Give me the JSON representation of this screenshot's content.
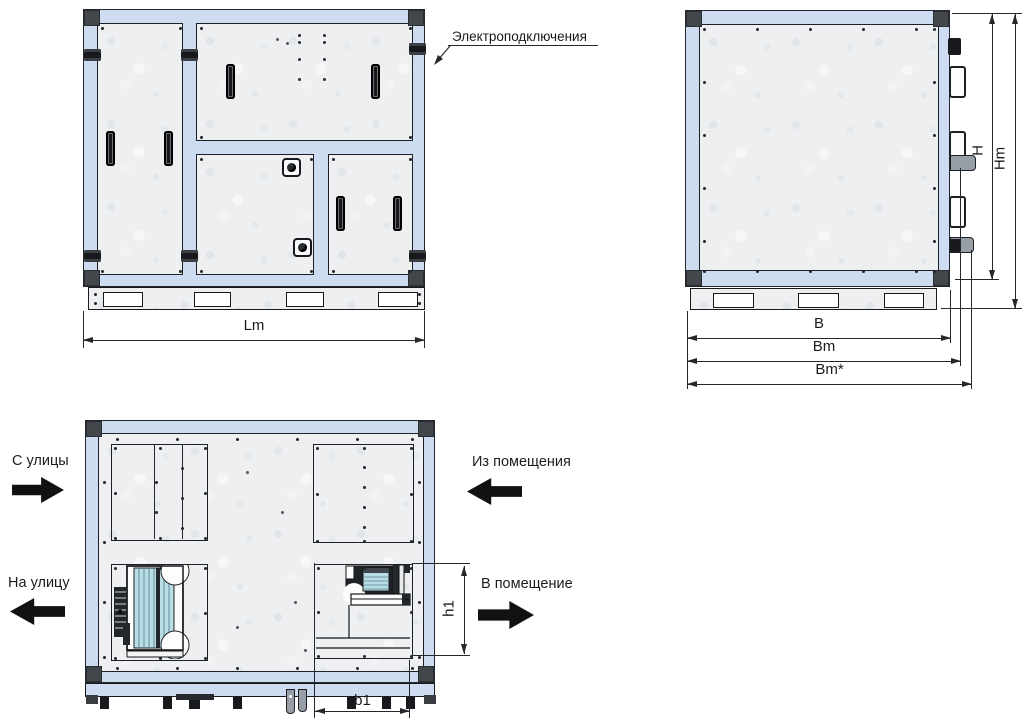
{
  "annotation": {
    "electrical": "Электроподключения"
  },
  "airflow": {
    "from_street": "С улицы",
    "to_street": "На улицу",
    "from_room": "Из помещения",
    "to_room": "В помещение"
  },
  "dims": {
    "Lm": "Lm",
    "B": "B",
    "Bm": "Bm",
    "BmStar": "Bm*",
    "H": "H",
    "Hm": "Hm",
    "h1": "h1",
    "b1": "b1"
  },
  "colors": {
    "frame_blue": "#cddcf1",
    "panel_gray": "#edeff1",
    "corner_dark": "#43464b",
    "line": "#24272b",
    "fan_teal": "#b9dde4",
    "arrow_black": "#111111"
  }
}
